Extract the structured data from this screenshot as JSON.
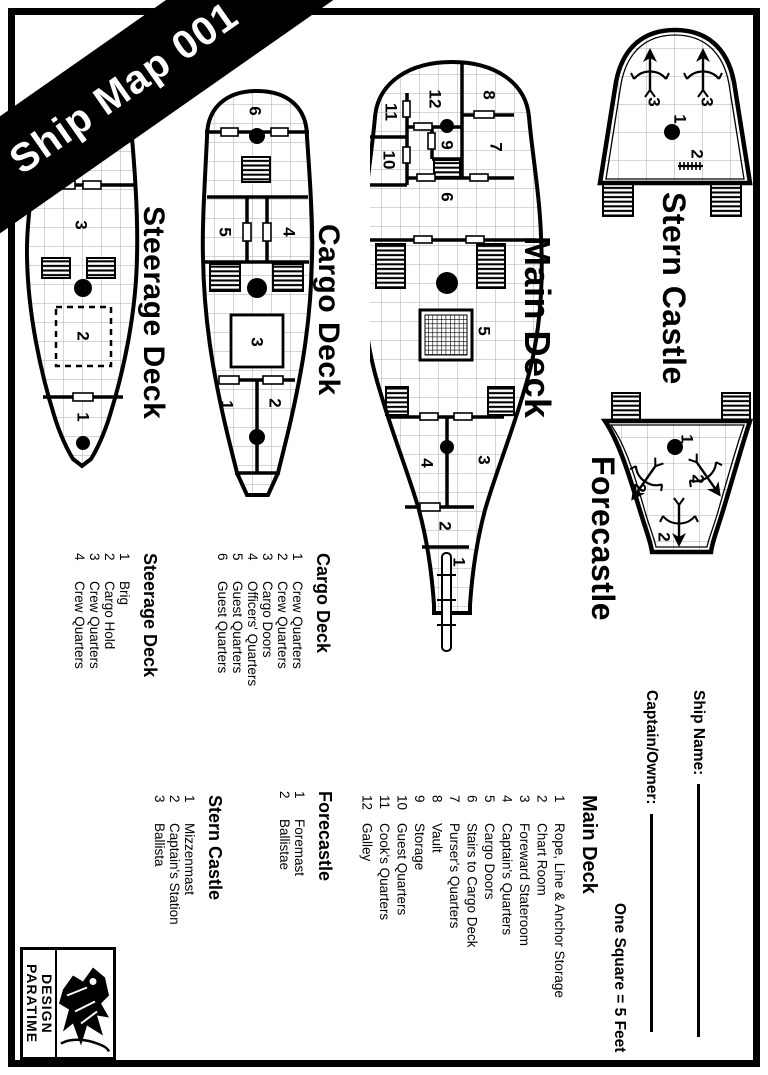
{
  "banner": {
    "title": "Ship Map 001"
  },
  "plans": {
    "steerage": {
      "label": "Steerage Deck"
    },
    "cargo": {
      "label": "Cargo Deck"
    },
    "main": {
      "label": "Main Deck"
    },
    "stern": {
      "label": "Stern Castle"
    },
    "forecastle": {
      "label": "Forecastle"
    }
  },
  "nums": {
    "1": "1",
    "2": "2",
    "3": "3",
    "4": "4",
    "5": "5",
    "6": "6",
    "7": "7",
    "8": "8",
    "9": "9",
    "10": "10",
    "11": "11",
    "12": "12"
  },
  "legends": {
    "steerage": {
      "title": "Steerage Deck",
      "items": [
        {
          "num": "1",
          "name": "Brig"
        },
        {
          "num": "2",
          "name": "Cargo Hold"
        },
        {
          "num": "3",
          "name": "Crew Quarters"
        },
        {
          "num": "4",
          "name": "Crew Quarters"
        }
      ]
    },
    "cargo": {
      "title": "Cargo Deck",
      "items": [
        {
          "num": "1",
          "name": "Crew Quarters"
        },
        {
          "num": "2",
          "name": "Crew Quarters"
        },
        {
          "num": "3",
          "name": "Cargo Doors"
        },
        {
          "num": "4",
          "name": "Officers' Quarters"
        },
        {
          "num": "5",
          "name": "Guest Quarters"
        },
        {
          "num": "6",
          "name": "Guest Quarters"
        }
      ]
    },
    "stern": {
      "title": "Stern Castle",
      "items": [
        {
          "num": "1",
          "name": "Mizzenmast"
        },
        {
          "num": "2",
          "name": "Captain's Station"
        },
        {
          "num": "3",
          "name": "Ballista"
        }
      ]
    },
    "forecastle": {
      "title": "Forecastle",
      "items": [
        {
          "num": "1",
          "name": "Foremast"
        },
        {
          "num": "2",
          "name": "Ballistae"
        }
      ]
    },
    "main": {
      "title": "Main Deck",
      "items": [
        {
          "num": "1",
          "name": "Rope, Line & Anchor Storage"
        },
        {
          "num": "2",
          "name": "Chart Room"
        },
        {
          "num": "3",
          "name": "Foreward Stateroom"
        },
        {
          "num": "4",
          "name": "Captain's Quarters"
        },
        {
          "num": "5",
          "name": "Cargo Doors"
        },
        {
          "num": "6",
          "name": "Stairs to Cargo Deck"
        },
        {
          "num": "7",
          "name": "Purser's Quarters"
        },
        {
          "num": "8",
          "name": "Vault"
        },
        {
          "num": "9",
          "name": "Storage"
        },
        {
          "num": "10",
          "name": "Guest Quarters"
        },
        {
          "num": "11",
          "name": "Cook's Quarters"
        },
        {
          "num": "12",
          "name": "Galley"
        }
      ]
    }
  },
  "fields": {
    "ship_name": "Ship Name:",
    "captain": "Captain/Owner:"
  },
  "scale_note": "One Square = 5 Feet",
  "logo": {
    "line1": "PARATIME",
    "line2": "DESIGN"
  },
  "colors": {
    "ink": "#000000",
    "grid": "#ababab",
    "paper": "#ffffff"
  }
}
